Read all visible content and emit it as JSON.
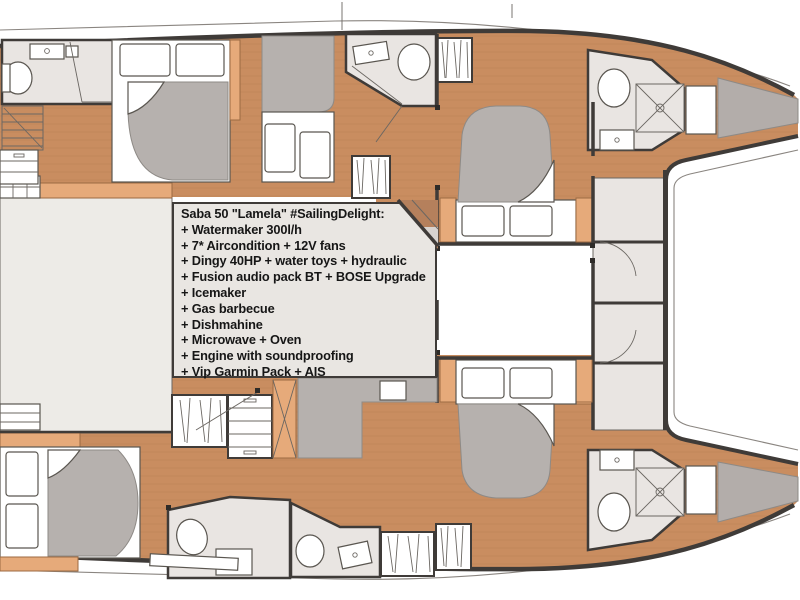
{
  "plan": {
    "boat_title": "Saba 50 \"Lamela\" #SailingDelight:",
    "features": [
      "+ Watermaker 300l/h",
      "+ 7* Aircondition + 12V fans",
      "+ Dingy 40HP + water toys + hydraulic",
      "+ Fusion audio pack BT + BOSE Upgrade",
      "+ Icemaker",
      "+ Gas barbecue",
      "+ Dishmahine",
      "+ Microwave + Oven",
      "+ Engine with soundproofing",
      "+ Vip Garmin Pack + AIS"
    ]
  },
  "colors": {
    "wood": "#c98d60",
    "wood_line": "#b57a4e",
    "wood_trim": "#e6aa7a",
    "wall": "#3f3b38",
    "bath": "#e9e5e2",
    "salon": "#edebe7",
    "mattress": "#b6b1ae",
    "bow": "#b3adaa",
    "box_bg": "#e9e6e2",
    "ink": "#161616",
    "thin": "#8a8580"
  }
}
